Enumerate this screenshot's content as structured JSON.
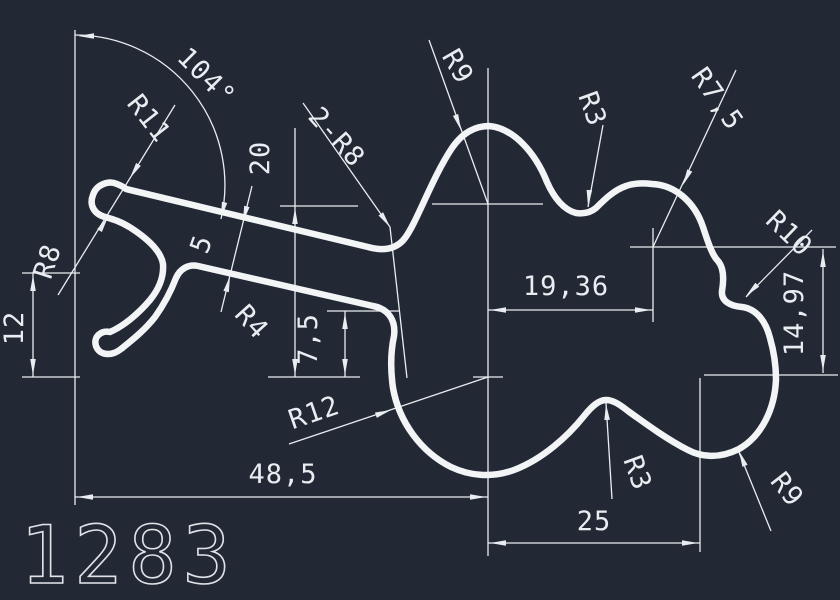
{
  "colors": {
    "background": "#222834",
    "line": "#f2f4f6",
    "dimension": "#e9edf1"
  },
  "drawing": {
    "number": "1283",
    "dimensions": {
      "angle": "104°",
      "r11": "R11",
      "r8": "R8",
      "h12": "12",
      "two_r8": "2-R8",
      "h20": "20",
      "t5": "5",
      "r4": "R4",
      "h7_5": "7,5",
      "r9_top": "R9",
      "r3_top": "R3",
      "r7_5": "R7,5",
      "r10": "R10",
      "w19_36": "19,36",
      "h14_97": "14,97",
      "r12": "R12",
      "w48_5": "48,5",
      "r3_bottom": "R3",
      "w25": "25",
      "r9_bottom": "R9"
    }
  }
}
